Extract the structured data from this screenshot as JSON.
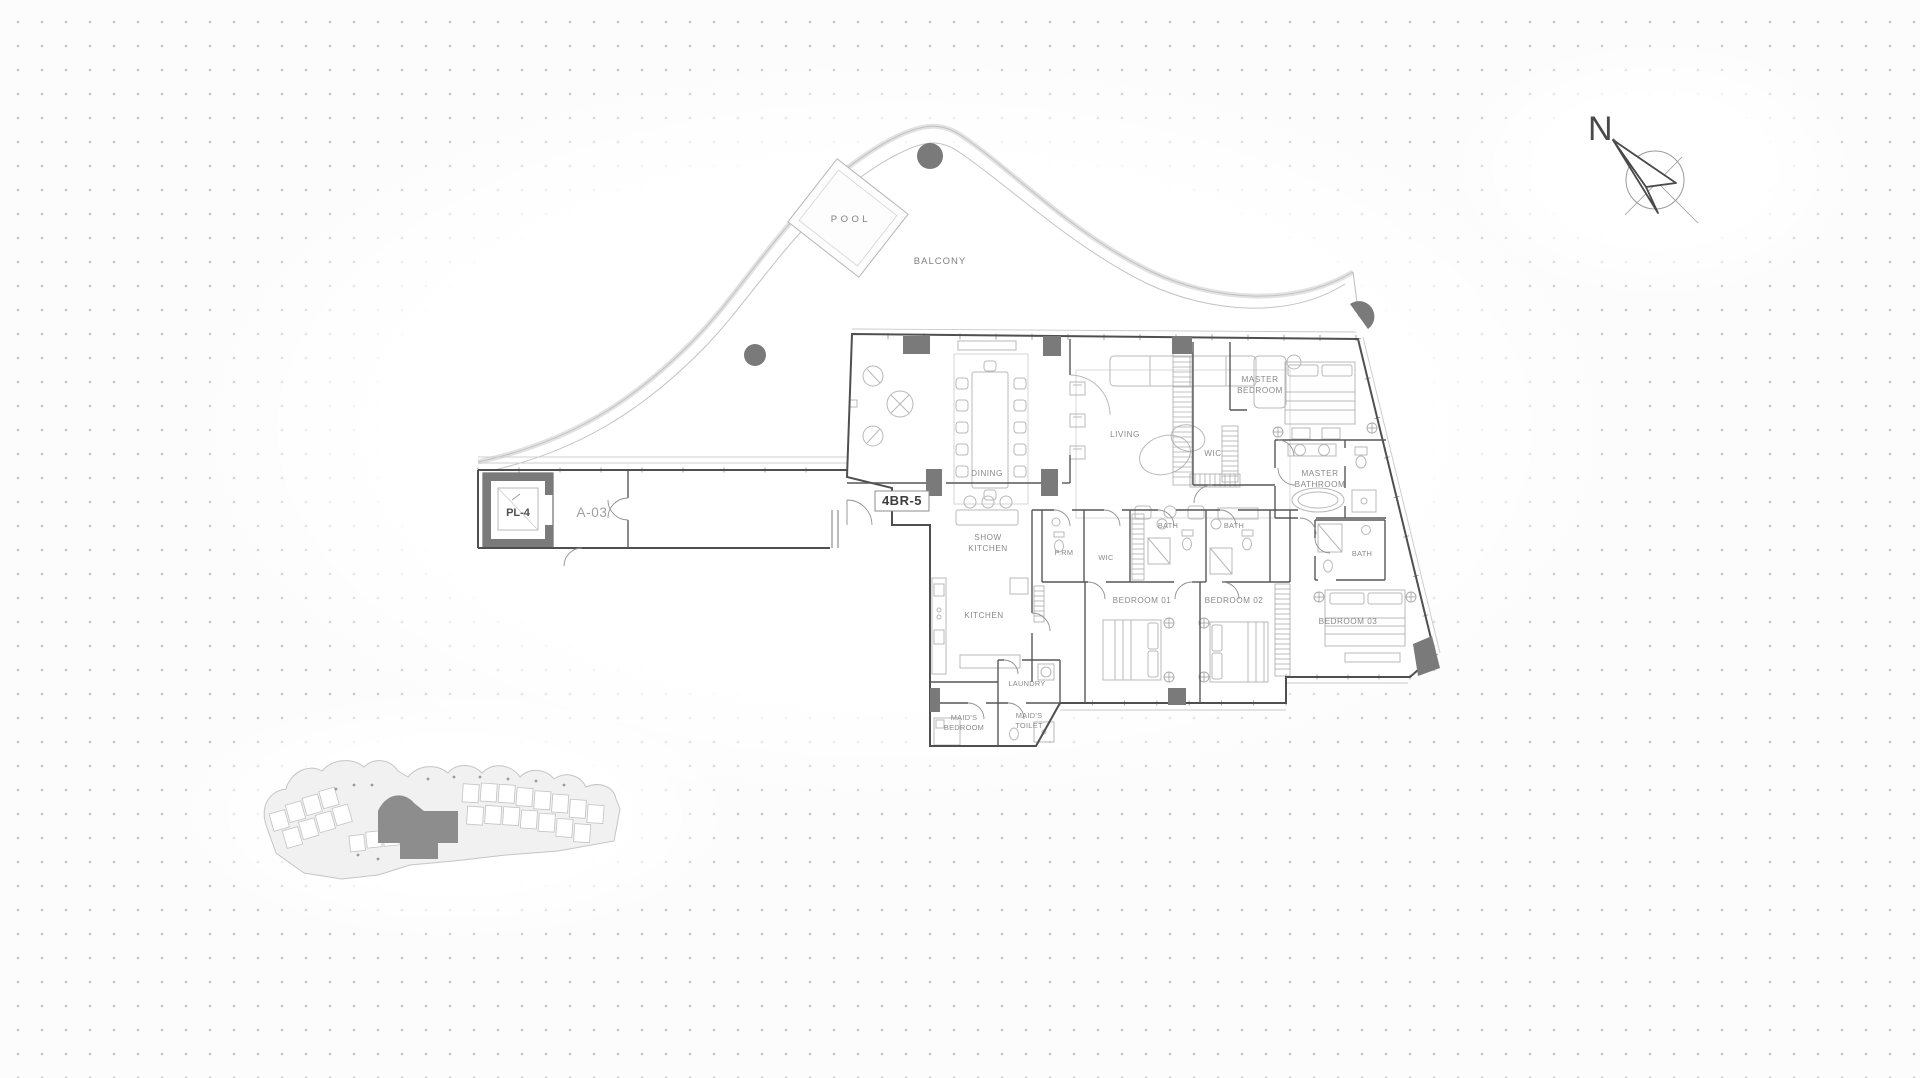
{
  "title": "Residential unit floor plan 4BR-5",
  "compass": {
    "north": "N"
  },
  "unit": {
    "badge": "4BR-5"
  },
  "core": {
    "lift": "PL-4",
    "lobby": "A-03"
  },
  "outdoor": {
    "pool": "POOL",
    "balcony": "BALCONY"
  },
  "rooms": {
    "living": "LIVING",
    "dining": "DINING",
    "master_bedroom": [
      "MASTER",
      "BEDROOM"
    ],
    "wic_master": "WIC",
    "master_bathroom": [
      "MASTER",
      "BATHROOM"
    ],
    "bath": "BATH",
    "powder": "P.RM",
    "wic": "WIC",
    "show_kitchen": [
      "SHOW",
      "KITCHEN"
    ],
    "kitchen": "KITCHEN",
    "bedroom_01": "BEDROOM 01",
    "bedroom_02": "BEDROOM 02",
    "bedroom_03": "BEDROOM 03",
    "laundry": "LAUNDRY",
    "maids_bedroom": [
      "MAID'S",
      "BEDROOM"
    ],
    "maids_toilet": [
      "MAID'S",
      "TOILET"
    ]
  },
  "colors": {
    "background": "#fcfcfc",
    "dot": "#c6c6c6",
    "wall": "#4f4f4f",
    "structure_fill": "#7a7a7a",
    "furniture": "#b5b5b5",
    "balcony_line": "#c9c9c9",
    "label": "#8a8a8a"
  }
}
